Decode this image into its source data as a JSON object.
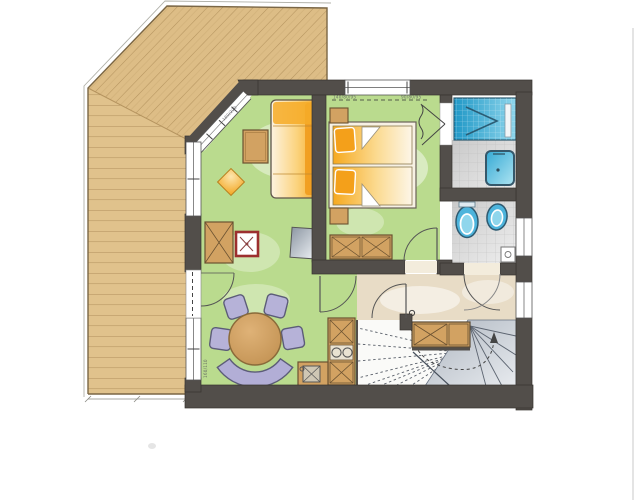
{
  "document": {
    "type": "architectural-floor-plan",
    "style": "hand-colored marker rendering",
    "floor": "apartment level with terrace and winder stair"
  },
  "annotations": {
    "bedroom_window_dim_left": "140/80/95",
    "bedroom_window_dim_right": "90/80/95",
    "terrace_window_dim": "160/110",
    "glass_front_dim": "180/220"
  },
  "rooms": [
    {
      "id": "terrace",
      "desc": "wood deck, diagonal and horizontal planks"
    },
    {
      "id": "living-dining",
      "desc": "green floor, sofa, coffee table, dining set, kitchenette"
    },
    {
      "id": "bedroom",
      "desc": "green floor, double bed, nightstands, dresser"
    },
    {
      "id": "bathroom",
      "desc": "shower, washbasin, gray tiles"
    },
    {
      "id": "wc",
      "desc": "toilet and bidet, gray tiles"
    },
    {
      "id": "hall",
      "desc": "beige floor, four door swings"
    },
    {
      "id": "stairs",
      "desc": "winder staircase with walk line arrow"
    }
  ],
  "furniture": [
    "sofa",
    "coffee-table",
    "pouf",
    "tv-board",
    "wood-stove",
    "cabinet",
    "dining-table",
    "chairs",
    "curved-bench",
    "kitchen-column",
    "sink-unit",
    "double-bed",
    "nightstands",
    "dresser",
    "stair-cabinet",
    "shower",
    "washbasin",
    "toilet",
    "bidet",
    "hand-basin"
  ],
  "palette": {
    "wall": "#524e4a",
    "wood_terrace": "#ddbd86",
    "wood_plank_line": "#b5945f",
    "floor_living": "#badb8e",
    "floor_hall": "#e8dcc6",
    "floor_bath_tile": "#d9d9d9",
    "fixture_blue": "#3fb0da",
    "furniture_wood": "#d2a262",
    "sofa_orange": "#f5a826",
    "bed_orange": "#f6a91f",
    "chair_purple": "#b6b2d8",
    "stove_red": "#9c2f2f",
    "stair_gray": "#bcc2ca"
  }
}
